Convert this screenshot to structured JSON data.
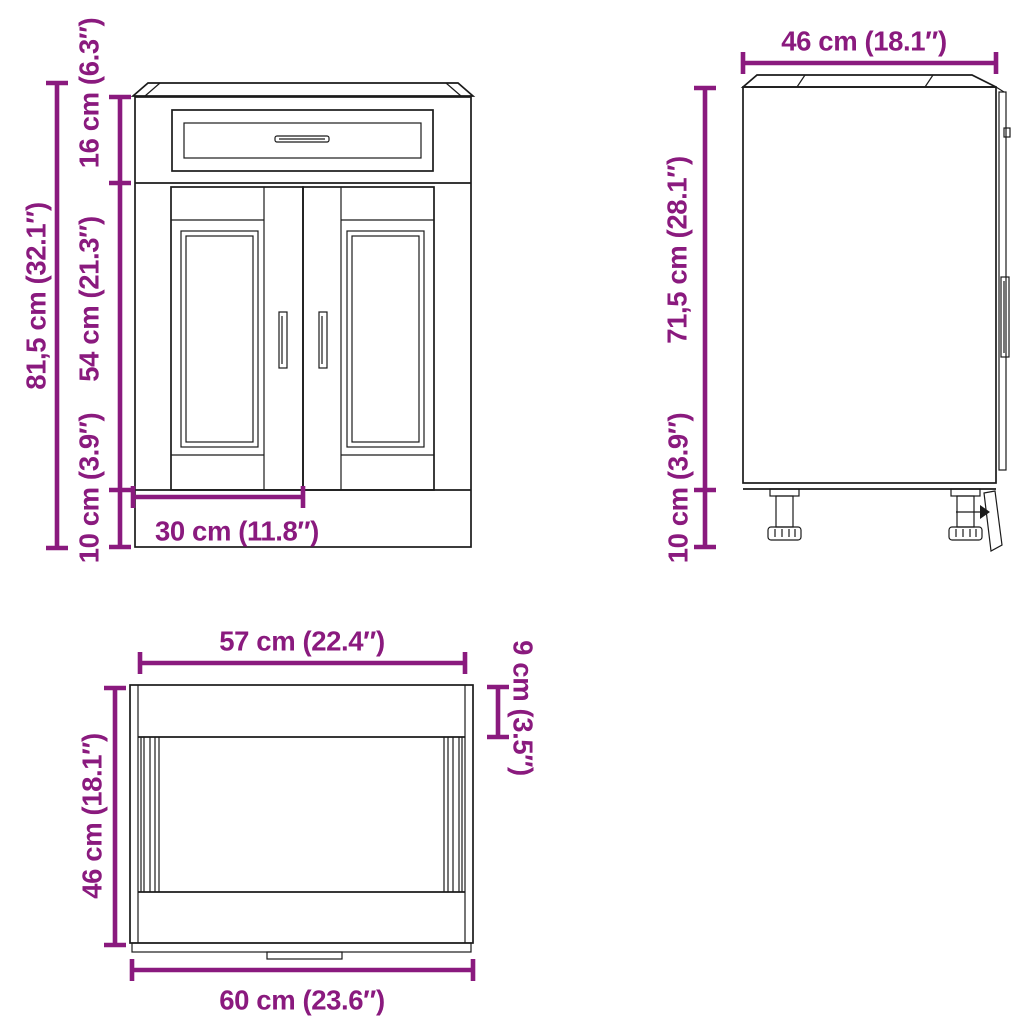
{
  "colors": {
    "dimension": "#8A1A7E",
    "line": "#1B1B1B",
    "background": "#FFFFFF"
  },
  "views": {
    "front": {
      "labels": {
        "total_height": "81,5 cm (32.1″)",
        "drawer_height": "16 cm (6.3″)",
        "door_height": "54 cm (21.3″)",
        "plinth_height": "10 cm (3.9″)",
        "door_width": "30 cm (11.8″)"
      }
    },
    "side": {
      "labels": {
        "depth": "46 cm (18.1″)",
        "body_height": "71,5 cm (28.1″)",
        "leg_height": "10 cm (3.9″)"
      }
    },
    "top": {
      "labels": {
        "inner_width": "57 cm (22.4″)",
        "front_band_depth": "9 cm (3.5″)",
        "depth": "46 cm (18.1″)",
        "total_width": "60 cm (23.6″)"
      }
    }
  }
}
